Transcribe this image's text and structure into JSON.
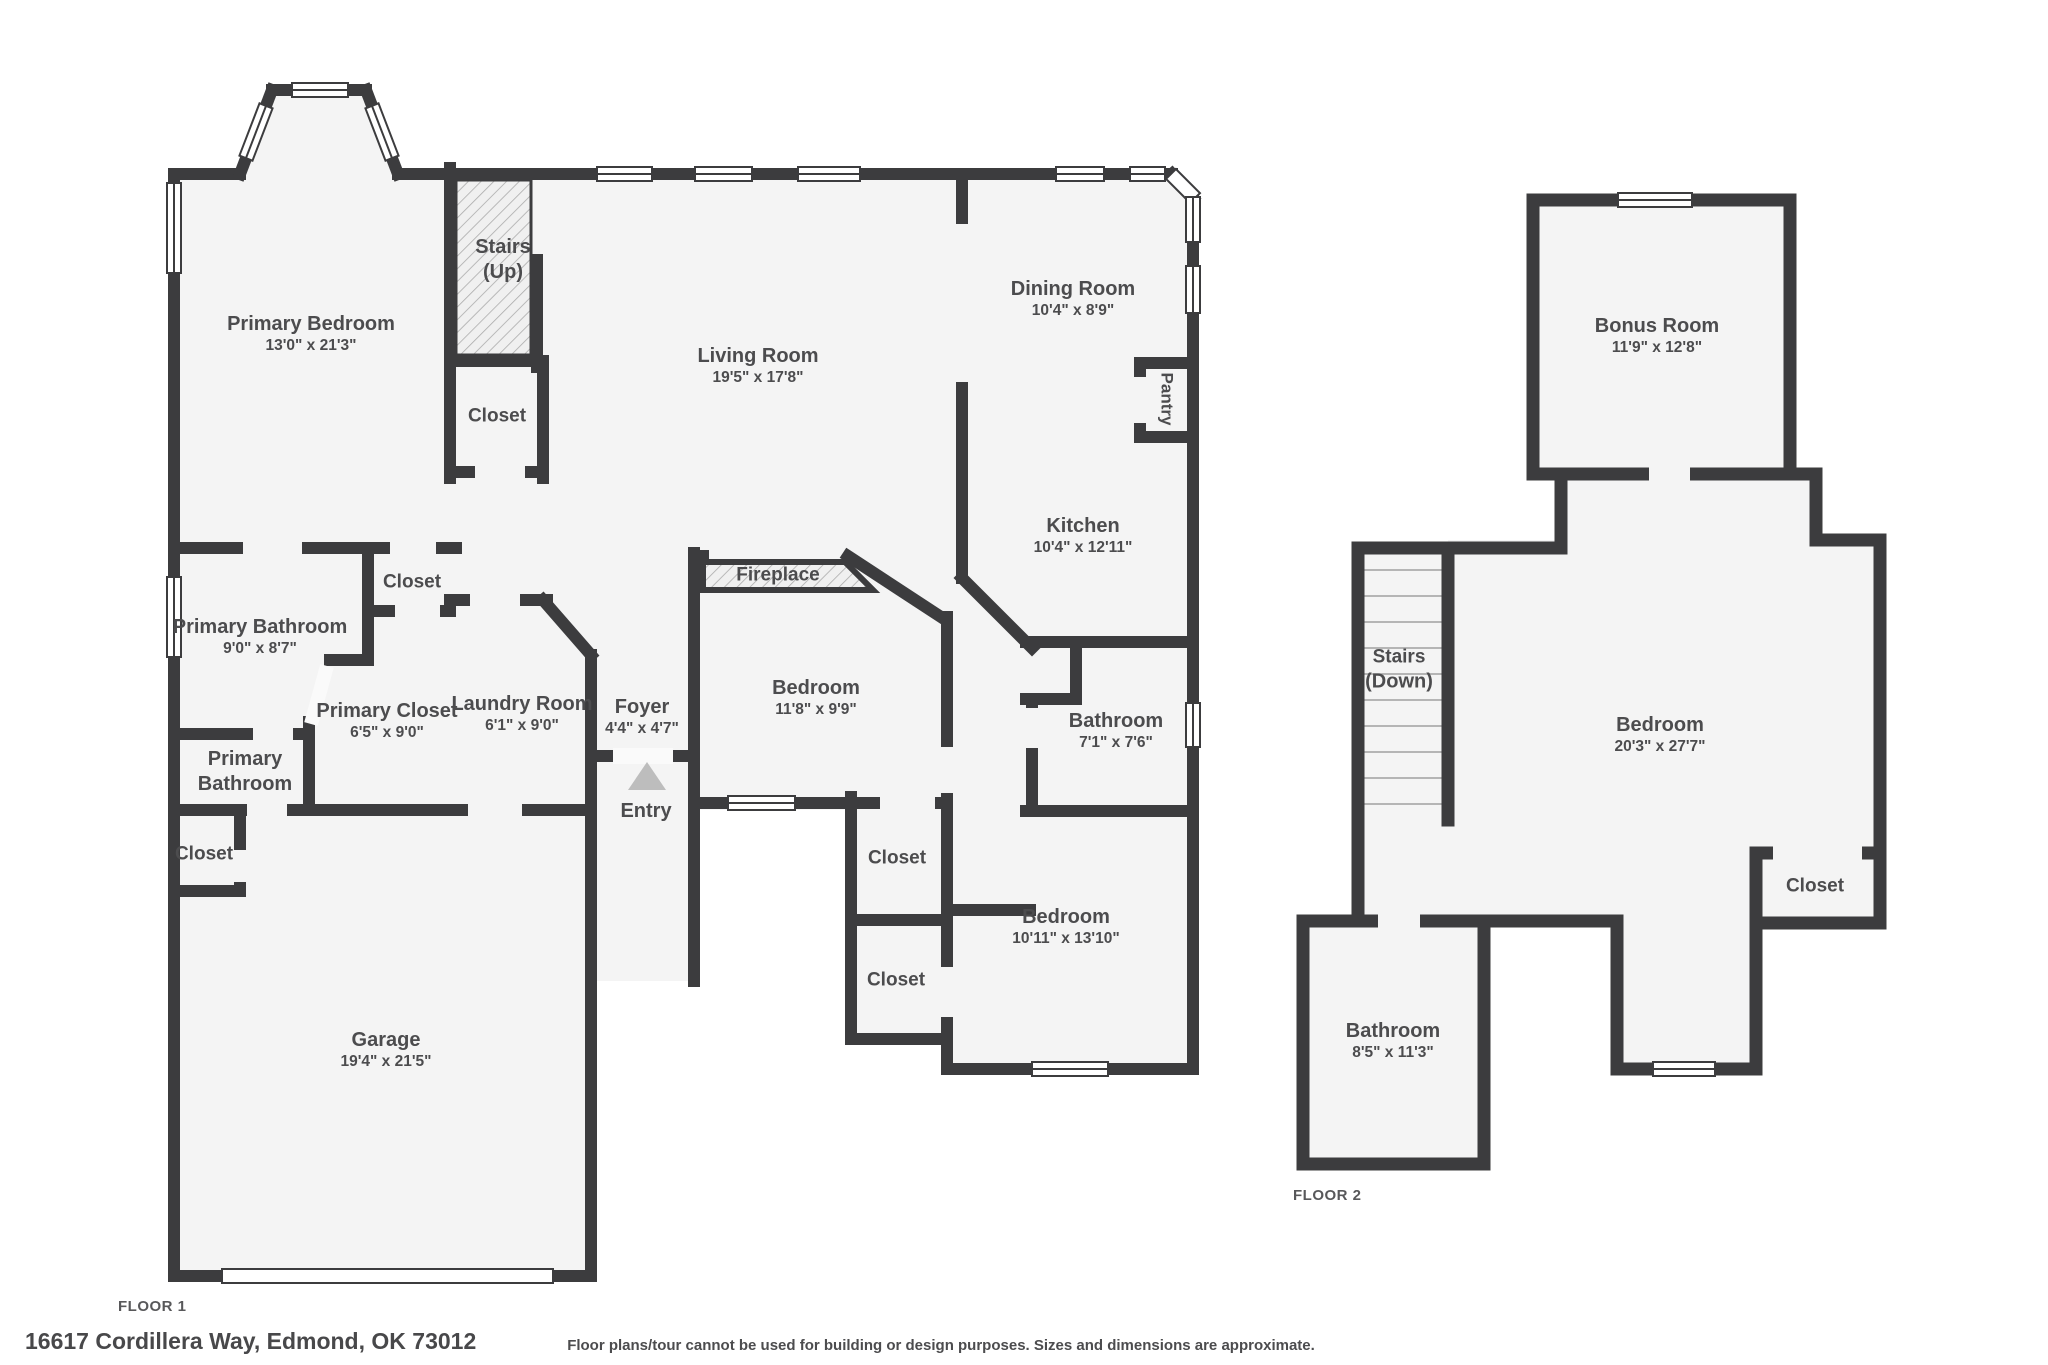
{
  "meta": {
    "floor1_label": "FLOOR 1",
    "floor2_label": "FLOOR 2",
    "address": "16617 Cordillera Way, Edmond, OK 73012",
    "disclaimer": "Floor plans/tour cannot be used for building or design purposes. Sizes and dimensions are approximate."
  },
  "colors": {
    "wall": "#3c3c3e",
    "room_fill": "#f4f4f4",
    "background": "#ffffff",
    "label": "#4c4c4e"
  },
  "floor1": {
    "primary_bedroom": {
      "line1": "Primary Bedroom",
      "line2": "13'0\" x 21'3\""
    },
    "stairs_up": {
      "line1": "Stairs",
      "line2": "(Up)"
    },
    "closet_under_stairs": {
      "line1": "Closet"
    },
    "living_room": {
      "line1": "Living Room",
      "line2": "19'5\" x 17'8\""
    },
    "dining_room": {
      "line1": "Dining Room",
      "line2": "10'4\" x 8'9\""
    },
    "pantry": {
      "line1": "Pantry"
    },
    "kitchen": {
      "line1": "Kitchen",
      "line2": "10'4\" x 12'11\""
    },
    "hall_closet": {
      "line1": "Closet"
    },
    "primary_bathroom": {
      "line1": "Primary Bathroom",
      "line2": "9'0\" x 8'7\""
    },
    "primary_closet": {
      "line1": "Primary Closet",
      "line2": "6'5\" x 9'0\""
    },
    "primary_bathroom_2": {
      "line1": "Primary",
      "line2": "Bathroom"
    },
    "garage_closet": {
      "line1": "Closet"
    },
    "laundry_room": {
      "line1": "Laundry Room",
      "line2": "6'1\" x 9'0\""
    },
    "foyer": {
      "line1": "Foyer",
      "line2": "4'4\" x 4'7\""
    },
    "entry": {
      "line1": "Entry"
    },
    "fireplace": {
      "line1": "Fireplace"
    },
    "bedroom_1": {
      "line1": "Bedroom",
      "line2": "11'8\" x 9'9\""
    },
    "bathroom": {
      "line1": "Bathroom",
      "line2": "7'1\" x 7'6\""
    },
    "closet_a": {
      "line1": "Closet"
    },
    "closet_b": {
      "line1": "Closet"
    },
    "bedroom_2": {
      "line1": "Bedroom",
      "line2": "10'11\" x 13'10\""
    },
    "garage": {
      "line1": "Garage",
      "line2": "19'4\" x 21'5\""
    }
  },
  "floor2": {
    "bonus_room": {
      "line1": "Bonus Room",
      "line2": "11'9\" x 12'8\""
    },
    "stairs_down": {
      "line1": "Stairs",
      "line2": "(Down)"
    },
    "bedroom": {
      "line1": "Bedroom",
      "line2": "20'3\" x 27'7\""
    },
    "closet": {
      "line1": "Closet"
    },
    "bathroom": {
      "line1": "Bathroom",
      "line2": "8'5\" x 11'3\""
    }
  }
}
